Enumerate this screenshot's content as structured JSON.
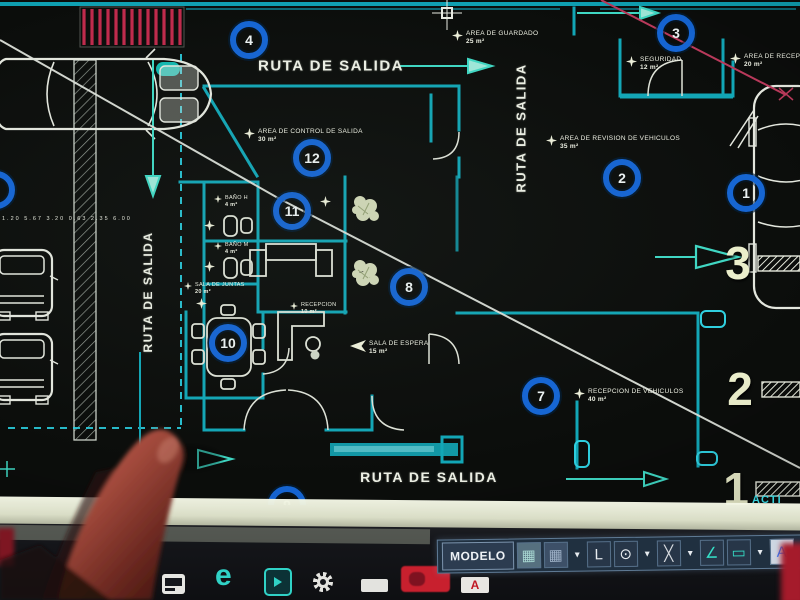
{
  "drawing": {
    "route_labels": [
      {
        "label": "RUTA DE SALIDA",
        "x": 331,
        "y": 66,
        "rot": 0,
        "size": 15
      },
      {
        "label": "RUTA DE SALIDA",
        "x": 148,
        "y": 292,
        "rot": -90,
        "size": 12
      },
      {
        "label": "RUTA DE SALIDA",
        "x": 521,
        "y": 128,
        "rot": -90,
        "size": 13
      },
      {
        "label": "RUTA DE SALIDA",
        "x": 429,
        "y": 477,
        "rot": 0,
        "size": 14
      }
    ],
    "zone_circles": [
      {
        "n": "4",
        "x": 249,
        "y": 40
      },
      {
        "n": "3",
        "x": 676,
        "y": 33
      },
      {
        "n": "12",
        "x": 312,
        "y": 158
      },
      {
        "n": "11",
        "x": 292,
        "y": 211
      },
      {
        "n": "2",
        "x": 622,
        "y": 178
      },
      {
        "n": "1",
        "x": 746,
        "y": 193
      },
      {
        "n": "8",
        "x": 409,
        "y": 287
      },
      {
        "n": "10",
        "x": 228,
        "y": 343
      },
      {
        "n": "7",
        "x": 541,
        "y": 396
      },
      {
        "n": "9",
        "x": 287,
        "y": 505
      },
      {
        "n": "",
        "x": -4,
        "y": 190
      }
    ],
    "grid_numbers": [
      {
        "n": "3",
        "x": 738,
        "y": 263
      },
      {
        "n": "2",
        "x": 740,
        "y": 389
      },
      {
        "n": "1",
        "x": 736,
        "y": 489
      }
    ],
    "area_labels": [
      {
        "name": "AREA DE GUARDADO",
        "area": "25 m²",
        "x": 452,
        "y": 30
      },
      {
        "name": "AREA DE CONTROL DE SALIDA",
        "area": "30 m²",
        "x": 244,
        "y": 128
      },
      {
        "name": "SEGURIDAD",
        "area": "12 m²",
        "x": 626,
        "y": 56
      },
      {
        "name": "AREA DE RECEPCION",
        "area": "20 m²",
        "x": 730,
        "y": 53
      },
      {
        "name": "AREA DE REVISION DE VEHICULOS",
        "area": "35 m²",
        "x": 546,
        "y": 135
      },
      {
        "name": "SALA DE ESPERA",
        "area": "15 m²",
        "x": 350,
        "y": 340,
        "cls": "arrow"
      },
      {
        "name": "RECEPCION DE VEHICULOS",
        "area": "40 m²",
        "x": 574,
        "y": 388
      },
      {
        "name": "SALA DE JUNTAS",
        "area": "20 m²",
        "x": 184,
        "y": 282,
        "cls": "tiny"
      },
      {
        "name": "RECEPCION",
        "area": "10 m²",
        "x": 290,
        "y": 302,
        "cls": "tiny"
      },
      {
        "name": "BAÑO H",
        "area": "4 m²",
        "x": 214,
        "y": 195,
        "cls": "tiny"
      },
      {
        "name": "BAÑO M",
        "area": "4 m²",
        "x": 214,
        "y": 242,
        "cls": "tiny"
      },
      {
        "name": "",
        "area": "",
        "x": 204,
        "y": 220
      },
      {
        "name": "",
        "area": "",
        "x": 204,
        "y": 261
      },
      {
        "name": "",
        "area": "",
        "x": 196,
        "y": 298
      },
      {
        "name": "",
        "area": "",
        "x": 320,
        "y": 196
      }
    ],
    "dimension_row": "1.20  5.67  3.20  0.63  2.35  6.00",
    "clipped_text": "ACTI",
    "colors": {
      "wall_teal": "#12a6b6",
      "circle_blue": "#1565d4",
      "cream": "#ecefcc",
      "hatch_red": "#c02a4c",
      "leader_red": "#bb3a5c"
    }
  },
  "status_bar": {
    "model_label": "MODELO",
    "icons": [
      {
        "name": "snap-grid-icon",
        "glyph": "▦",
        "color": "#a8d8d2",
        "bg": "#56707f"
      },
      {
        "name": "grid-display-icon",
        "glyph": "▦",
        "color": "#9fb2c8",
        "bg": "#3d5068"
      },
      {
        "name": "dropdown-arrow-icon",
        "glyph": "▾",
        "cls": "drop"
      },
      {
        "name": "ortho-mode-icon",
        "glyph": "L",
        "color": "#e8ecf0"
      },
      {
        "name": "polar-tracking-icon",
        "glyph": "⊙",
        "color": "#e8ecf0"
      },
      {
        "name": "dropdown-arrow-icon",
        "glyph": "▾",
        "cls": "drop"
      },
      {
        "name": "object-snap-icon",
        "glyph": "╳",
        "color": "#d8dce0"
      },
      {
        "name": "dropdown-arrow-icon",
        "glyph": "▾",
        "cls": "drop"
      },
      {
        "name": "angle-snap-icon",
        "glyph": "∠",
        "color": "#35e0c8"
      },
      {
        "name": "dynamic-input-icon",
        "glyph": "▭",
        "color": "#35e0c8"
      },
      {
        "name": "dropdown-arrow-icon",
        "glyph": "▾",
        "cls": "drop"
      },
      {
        "name": "annotation-user-icon",
        "glyph": "A",
        "color": "#2f7bff",
        "bg": "#cdd6e2"
      }
    ]
  },
  "taskbar": {
    "edge_glyph": "e",
    "autocad_letter": "A",
    "icons": [
      "movies-icon",
      "edge-icon",
      "premiere-icon",
      "settings-gear-icon",
      "files-icon",
      "youtube-icon",
      "autocad-icon"
    ]
  }
}
